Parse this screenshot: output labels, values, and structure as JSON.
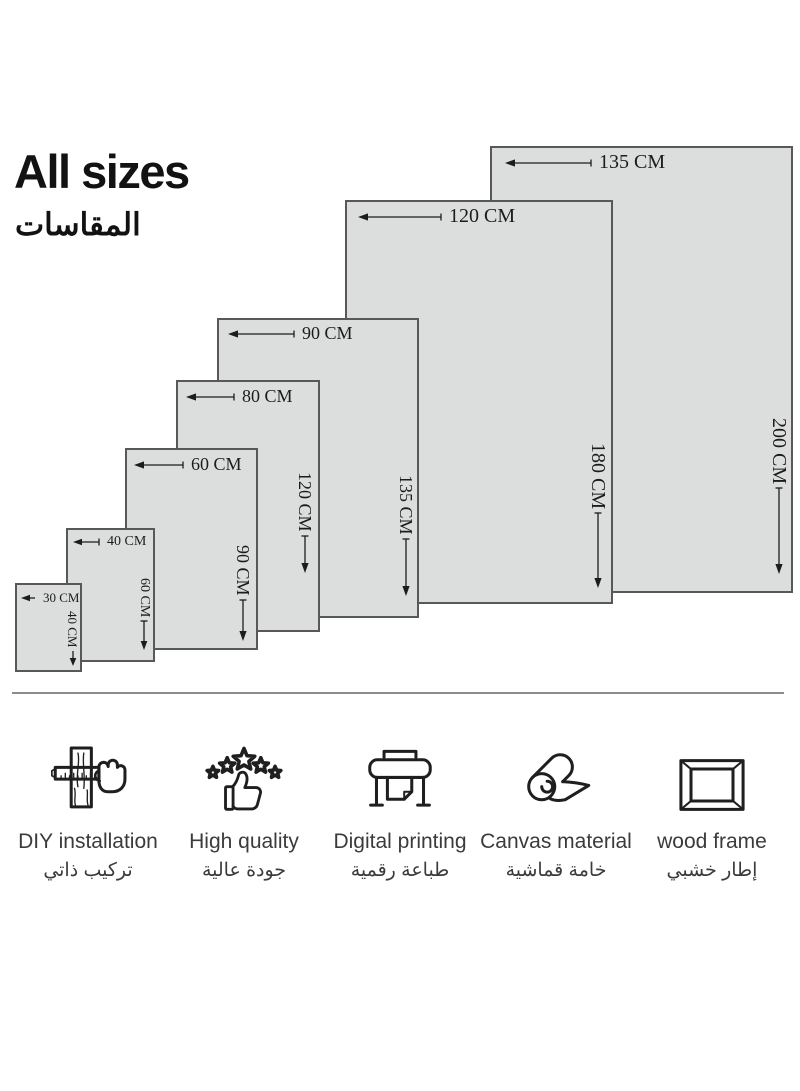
{
  "title": {
    "heading": "All sizes",
    "heading_ar": "المقاسات"
  },
  "sizes": [
    {
      "width": "30 CM",
      "height": "40 CM"
    },
    {
      "width": "40 CM",
      "height": "60 CM"
    },
    {
      "width": "60 CM",
      "height": "90 CM"
    },
    {
      "width": "80 CM",
      "height": "120 CM"
    },
    {
      "width": "90 CM",
      "height": "135 CM"
    },
    {
      "width": "120 CM",
      "height": "180 CM"
    },
    {
      "width": "135 CM",
      "height": "200 CM"
    }
  ],
  "features": [
    {
      "icon": "diy-installation-icon",
      "en": "DIY installation",
      "ar": "تركيب ذاتي"
    },
    {
      "icon": "high-quality-icon",
      "en": "High quality",
      "ar": "جودة عالية"
    },
    {
      "icon": "digital-printing-icon",
      "en": "Digital printing",
      "ar": "طباعة رقمية"
    },
    {
      "icon": "canvas-material-icon",
      "en": "Canvas material",
      "ar": "خامة قماشية"
    },
    {
      "icon": "wood-frame-icon",
      "en": "wood frame",
      "ar": "إطار خشبي"
    }
  ],
  "colors": {
    "rect_fill": "#dcdddd",
    "rect_border": "#58585a",
    "label_text": "#1c1c1c",
    "feature_text": "#3b3b3b",
    "divider": "#8c8c8c"
  }
}
